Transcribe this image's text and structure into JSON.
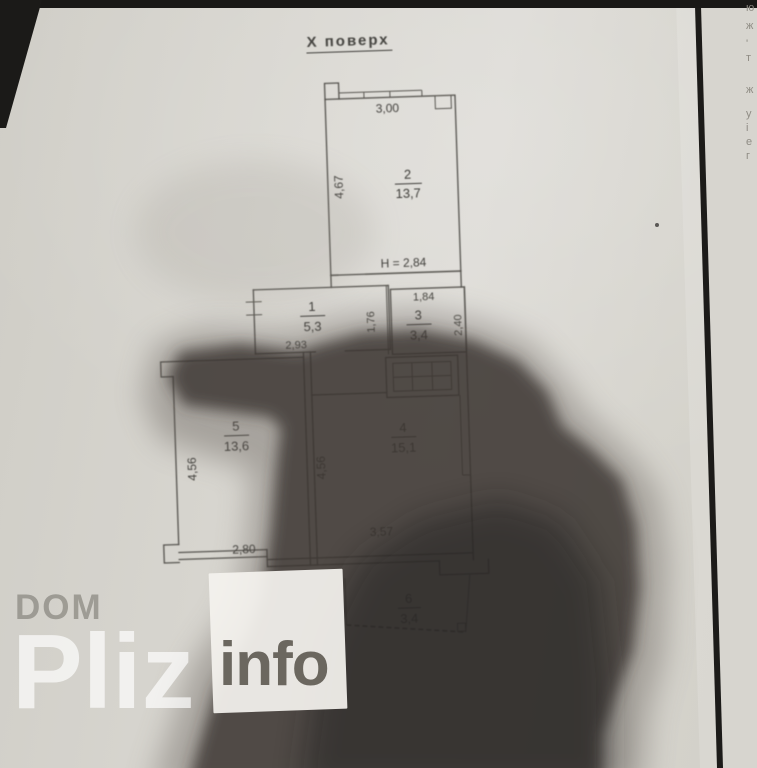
{
  "title": "Х  поверх",
  "plan": {
    "height_note": "Н = 2,84",
    "rooms": [
      {
        "num": "2",
        "area": "13,7"
      },
      {
        "num": "1",
        "area": "5,3"
      },
      {
        "num": "3",
        "area": "3,4"
      },
      {
        "num": "5",
        "area": "13,6"
      },
      {
        "num": "4",
        "area": "15,1"
      },
      {
        "num": "6",
        "area": "3,4"
      }
    ],
    "dims": {
      "room2_top": "3,00",
      "room2_left": "4,67",
      "room1_bottom": "2,93",
      "room1_right": "1,76",
      "room3_top": "1,84",
      "room3_right": "2,40",
      "room5_left": "4,56",
      "room5_bottom": "2,80",
      "room4_left": "4,56",
      "room4_bottom": "3,57"
    }
  },
  "watermark": {
    "dom": "DOM",
    "pliz": "Pliz",
    "info": "info"
  },
  "edge_fragments": [
    "ю",
    "ж",
    "'",
    "т",
    "ж",
    "у",
    "і",
    "е",
    "г"
  ],
  "colors": {
    "paper": "#d7d5cf",
    "ink": "#53514c",
    "shadow": "#37322f"
  }
}
